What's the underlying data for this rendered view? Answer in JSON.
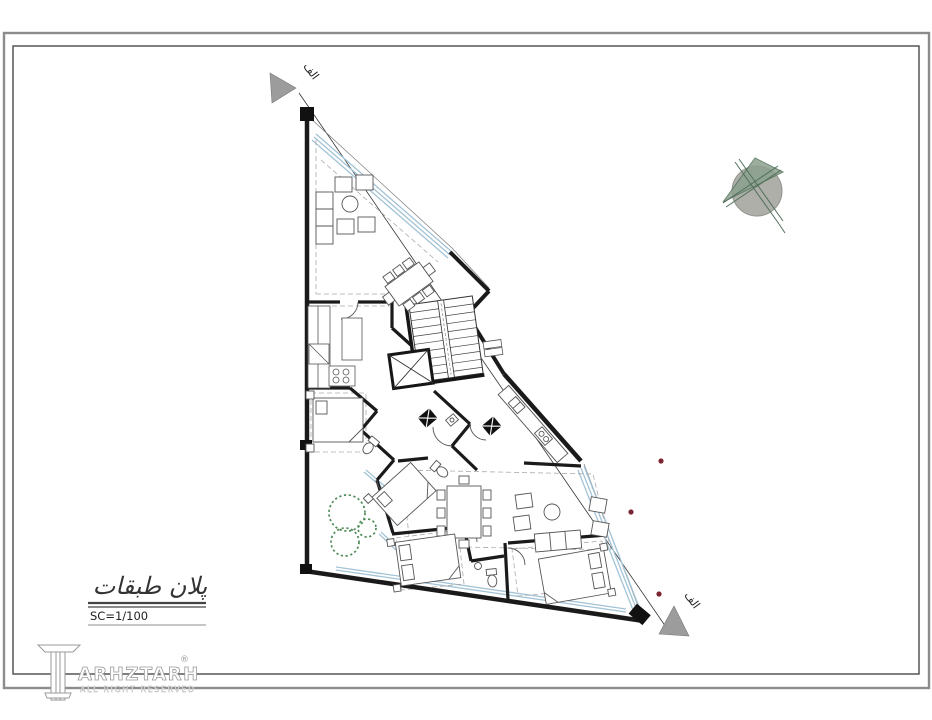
{
  "title_block": {
    "title": "پلان طبقات",
    "scale": "SC=1/100"
  },
  "logo": {
    "text": "ARHZTARH",
    "registered": "®",
    "tagline": "ALL RIGHT RESERVED"
  },
  "section": {
    "label_top": "الف",
    "label_bottom": "الف"
  },
  "colors": {
    "wall": "#1a1a1a",
    "window": "#a3c3d6",
    "tree": "#4e8a57",
    "marker": "#9c9c9c",
    "dot": "#7c2633",
    "north_green": "#51705a",
    "north_circle": "#a9aba4",
    "border_outer": "#8c8c8c",
    "border_inner": "#4a4a4a"
  }
}
